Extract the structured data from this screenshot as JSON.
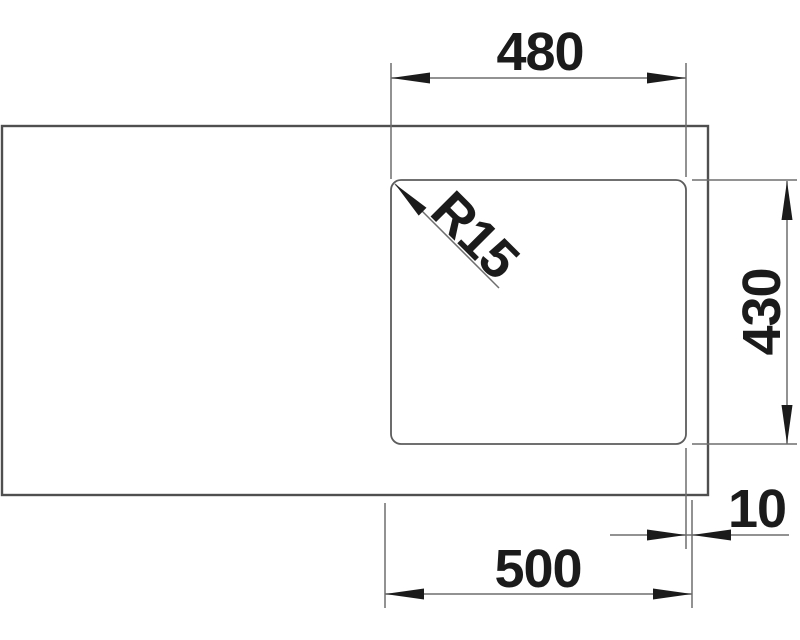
{
  "drawing": {
    "title": "sink-top-view-dimension-drawing",
    "labels": {
      "inner_width": "480",
      "inner_depth": "430",
      "corner_radius": "R15",
      "edge_offset": "10",
      "outer_width": "500"
    },
    "colors": {
      "background": "#ffffff",
      "outline": "#4f4f4f",
      "thin_line": "#6e6e6e",
      "annotation": "#1b1b1b"
    }
  }
}
